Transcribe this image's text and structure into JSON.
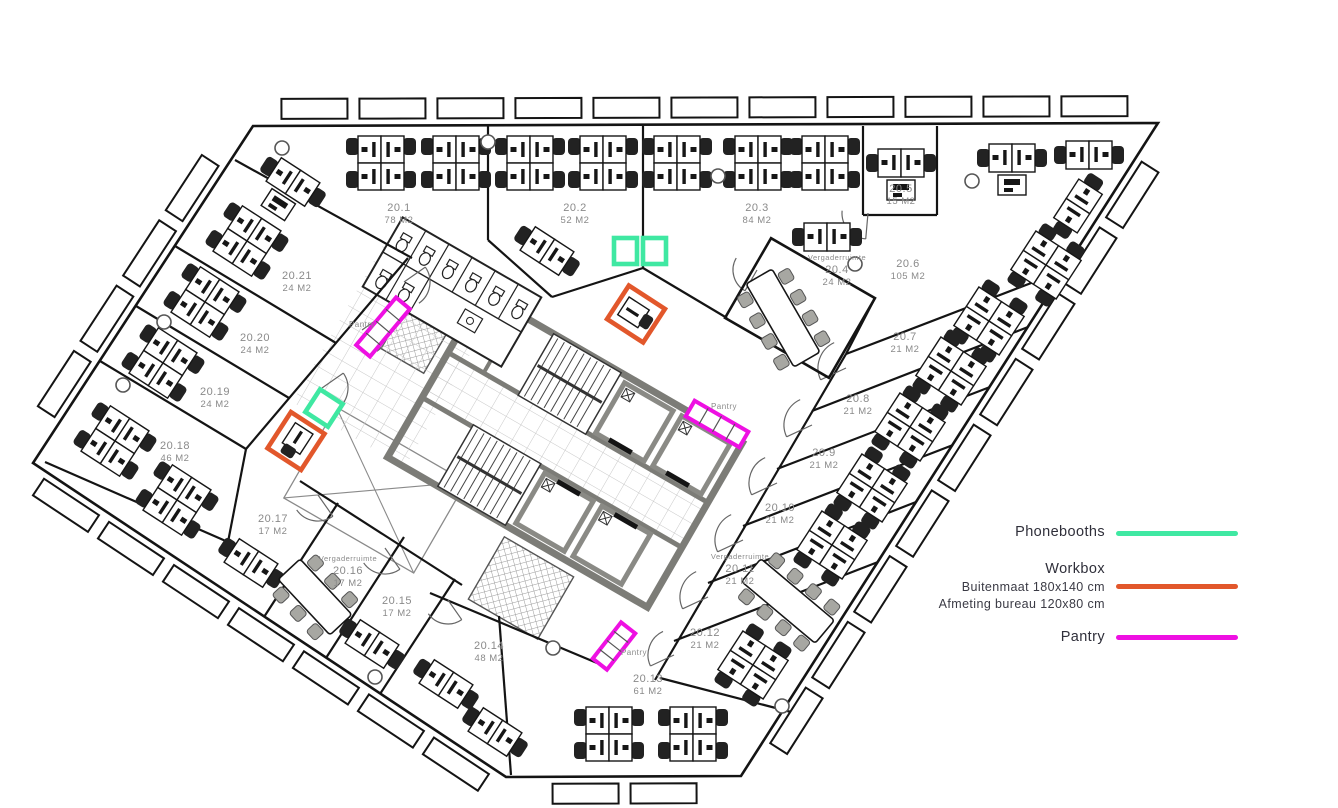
{
  "legend": {
    "phonebooths": {
      "label": "Phonebooths",
      "color": "#3FE8A2"
    },
    "workbox": {
      "label": "Workbox",
      "sub1": "Buitenmaat 180x140 cm",
      "sub2": "Afmeting bureau 120x80 cm",
      "color": "#E2572B"
    },
    "pantry": {
      "label": "Pantry",
      "color": "#EE10E2"
    }
  },
  "plan": {
    "canvas": {
      "w": 1338,
      "h": 808
    },
    "colors": {
      "wall": "#141414",
      "core_gray": "#7C7C77",
      "elev_gray": "#8A8A85",
      "label_gray": "#8A8A8A",
      "chair_black": "#222222",
      "meet_chair": "#A7A7A2",
      "green": "#3FE8A2",
      "orange": "#E2572B",
      "magenta": "#EE10E2"
    },
    "outline": [
      [
        253,
        126
      ],
      [
        1158,
        123
      ],
      [
        741,
        776
      ],
      [
        506,
        777
      ],
      [
        33,
        463
      ]
    ],
    "walls": [
      [
        488,
        126,
        488,
        240
      ],
      [
        488,
        240,
        552,
        297
      ],
      [
        552,
        297,
        643,
        268
      ],
      [
        643,
        126,
        643,
        268
      ],
      [
        643,
        268,
        727,
        318
      ],
      [
        863,
        126,
        863,
        215
      ],
      [
        863,
        215,
        937,
        215
      ],
      [
        937,
        126,
        937,
        215
      ],
      [
        875,
        298,
        846,
        354
      ],
      [
        846,
        354,
        655,
        680
      ],
      [
        846,
        354,
        1060,
        272
      ],
      [
        812,
        411,
        1028,
        327
      ],
      [
        777,
        469,
        990,
        387
      ],
      [
        743,
        526,
        953,
        445
      ],
      [
        708,
        583,
        916,
        502
      ],
      [
        674,
        641,
        878,
        562
      ],
      [
        660,
        678,
        795,
        713
      ],
      [
        235,
        160,
        412,
        258
      ],
      [
        408,
        258,
        246,
        449
      ],
      [
        175,
        246,
        336,
        343
      ],
      [
        136,
        306,
        289,
        398
      ],
      [
        100,
        361,
        246,
        449
      ],
      [
        246,
        449,
        228,
        542
      ],
      [
        45,
        462,
        228,
        542
      ],
      [
        300,
        481,
        462,
        585
      ],
      [
        264,
        617,
        338,
        503
      ],
      [
        326,
        658,
        404,
        537
      ],
      [
        380,
        694,
        455,
        579
      ],
      [
        430,
        593,
        597,
        663
      ],
      [
        499,
        616,
        511,
        775
      ]
    ],
    "core": {
      "x": 565,
      "y": 450,
      "rot": 30
    },
    "toilets": {
      "x": 452,
      "y": 292,
      "rot": 30
    },
    "rooms": [
      {
        "id": "20.1",
        "area": "78 M2",
        "x": 399,
        "y": 207
      },
      {
        "id": "20.2",
        "area": "52 M2",
        "x": 575,
        "y": 207
      },
      {
        "id": "20.3",
        "area": "84 M2",
        "x": 757,
        "y": 207
      },
      {
        "id": "20.4",
        "area": "24 M2",
        "x": 837,
        "y": 269,
        "prefix": "Vergaderruimte"
      },
      {
        "id": "20.5",
        "area": "15 M2",
        "x": 901,
        "y": 188
      },
      {
        "id": "20.6",
        "area": "105 M2",
        "x": 908,
        "y": 263
      },
      {
        "id": "20.7",
        "area": "21 M2",
        "x": 905,
        "y": 336
      },
      {
        "id": "20.8",
        "area": "21 M2",
        "x": 858,
        "y": 398
      },
      {
        "id": "20.9",
        "area": "21 M2",
        "x": 824,
        "y": 452
      },
      {
        "id": "20.10",
        "area": "21 M2",
        "x": 780,
        "y": 507
      },
      {
        "id": "20.11",
        "area": "21 M2",
        "x": 740,
        "y": 568,
        "prefix": "Vergaderruimte"
      },
      {
        "id": "20.12",
        "area": "21 M2",
        "x": 705,
        "y": 632
      },
      {
        "id": "20.13",
        "area": "61 M2",
        "x": 648,
        "y": 678
      },
      {
        "id": "20.14",
        "area": "48 M2",
        "x": 489,
        "y": 645
      },
      {
        "id": "20.15",
        "area": "17 M2",
        "x": 397,
        "y": 600
      },
      {
        "id": "20.16",
        "area": "17 M2",
        "x": 348,
        "y": 570,
        "prefix": "Vergaderruimte"
      },
      {
        "id": "20.17",
        "area": "17 M2",
        "x": 273,
        "y": 518
      },
      {
        "id": "20.18",
        "area": "46 M2",
        "x": 175,
        "y": 445
      },
      {
        "id": "20.19",
        "area": "24 M2",
        "x": 215,
        "y": 391
      },
      {
        "id": "20.20",
        "area": "24 M2",
        "x": 255,
        "y": 337
      },
      {
        "id": "20.21",
        "area": "24 M2",
        "x": 297,
        "y": 275
      }
    ],
    "small_labels": [
      {
        "text": "Pantry",
        "x": 362,
        "y": 327
      },
      {
        "text": "Pantry",
        "x": 724,
        "y": 409
      },
      {
        "text": "Pantry",
        "x": 634,
        "y": 655
      }
    ],
    "arcs": [
      [
        868,
        213,
        26,
        95
      ],
      [
        846,
        368,
        28,
        155
      ],
      [
        812,
        425,
        28,
        155
      ],
      [
        777,
        483,
        28,
        155
      ],
      [
        743,
        540,
        28,
        155
      ],
      [
        708,
        597,
        28,
        155
      ],
      [
        674,
        655,
        26,
        155
      ],
      [
        404,
        282,
        26,
        -35
      ],
      [
        362,
        330,
        26,
        -35
      ],
      [
        322,
        388,
        26,
        -35
      ],
      [
        282,
        445,
        26,
        -35
      ],
      [
        318,
        495,
        26,
        55
      ],
      [
        385,
        548,
        26,
        55
      ],
      [
        448,
        600,
        24,
        55
      ],
      [
        757,
        270,
        24,
        120
      ]
    ],
    "items": [
      {
        "t": "hatch",
        "x": 410,
        "y": 333,
        "r": 30,
        "w": 64,
        "h": 56
      },
      {
        "t": "hatch",
        "x": 521,
        "y": 588,
        "r": 30,
        "w": 80,
        "h": 72
      },
      {
        "t": "xvoid",
        "x": 375,
        "y": 490,
        "r": 30,
        "w": 150,
        "h": 105
      },
      {
        "t": "roomrect",
        "x": 800,
        "y": 308,
        "r": 30,
        "w": 120,
        "h": 92
      },
      {
        "t": "pod4",
        "x": 381,
        "y": 163,
        "r": 0
      },
      {
        "t": "pod4",
        "x": 456,
        "y": 163,
        "r": 0
      },
      {
        "t": "pod4",
        "x": 530,
        "y": 163,
        "r": 0
      },
      {
        "t": "pod4",
        "x": 603,
        "y": 163,
        "r": 0
      },
      {
        "t": "pod4",
        "x": 677,
        "y": 163,
        "r": 0
      },
      {
        "t": "pod4",
        "x": 758,
        "y": 163,
        "r": 0
      },
      {
        "t": "pod4",
        "x": 825,
        "y": 163,
        "r": 0
      },
      {
        "t": "pod2",
        "x": 827,
        "y": 237,
        "r": 0
      },
      {
        "t": "pod2p",
        "x": 901,
        "y": 163,
        "r": 0
      },
      {
        "t": "pod2p",
        "x": 1012,
        "y": 158,
        "r": 0
      },
      {
        "t": "pod2",
        "x": 1089,
        "y": 155,
        "r": 0
      },
      {
        "t": "pod2p",
        "x": 293,
        "y": 182,
        "r": 33
      },
      {
        "t": "pod2",
        "x": 547,
        "y": 251,
        "r": 33
      },
      {
        "t": "pod2",
        "x": 1078,
        "y": 206,
        "r": -57
      },
      {
        "t": "pod4",
        "x": 1046,
        "y": 265,
        "r": -57
      },
      {
        "t": "pod4",
        "x": 989,
        "y": 321,
        "r": -57
      },
      {
        "t": "pod4",
        "x": 951,
        "y": 371,
        "r": -57
      },
      {
        "t": "pod4",
        "x": 910,
        "y": 427,
        "r": -57
      },
      {
        "t": "pod4",
        "x": 872,
        "y": 488,
        "r": -57
      },
      {
        "t": "pod4",
        "x": 832,
        "y": 545,
        "r": -57
      },
      {
        "t": "pod4",
        "x": 753,
        "y": 665,
        "r": -57
      },
      {
        "t": "pod4",
        "x": 609,
        "y": 734,
        "r": 0
      },
      {
        "t": "pod4",
        "x": 693,
        "y": 734,
        "r": 0
      },
      {
        "t": "pod2",
        "x": 446,
        "y": 684,
        "r": 33
      },
      {
        "t": "pod2",
        "x": 495,
        "y": 732,
        "r": 33
      },
      {
        "t": "pod2",
        "x": 372,
        "y": 644,
        "r": 33
      },
      {
        "t": "pod2",
        "x": 251,
        "y": 563,
        "r": 33
      },
      {
        "t": "pod4",
        "x": 247,
        "y": 241,
        "r": 33
      },
      {
        "t": "pod4",
        "x": 205,
        "y": 302,
        "r": 33
      },
      {
        "t": "pod4",
        "x": 163,
        "y": 363,
        "r": 33
      },
      {
        "t": "pod4",
        "x": 115,
        "y": 441,
        "r": 33
      },
      {
        "t": "pod4",
        "x": 177,
        "y": 500,
        "r": 33
      },
      {
        "t": "meet",
        "x": 783,
        "y": 318,
        "r": -30,
        "seats": 8
      },
      {
        "t": "meet",
        "x": 788,
        "y": 601,
        "r": -50,
        "seats": 8
      },
      {
        "t": "meet",
        "x": 315,
        "y": 597,
        "r": -43,
        "seats": 6
      },
      {
        "t": "booth2",
        "x": 640,
        "y": 251,
        "r": 0
      },
      {
        "t": "booth1",
        "x": 324,
        "y": 408,
        "r": 33
      },
      {
        "t": "wbox",
        "x": 296,
        "y": 441,
        "r": 33
      },
      {
        "t": "wbox",
        "x": 636,
        "y": 314,
        "r": -57
      },
      {
        "t": "pbox",
        "x": 383,
        "y": 327,
        "r": -50,
        "len": 62
      },
      {
        "t": "pbox",
        "x": 717,
        "y": 424,
        "r": 30,
        "len": 62
      },
      {
        "t": "pbox",
        "x": 614,
        "y": 646,
        "r": -52,
        "len": 46
      },
      {
        "t": "col",
        "x": 282,
        "y": 148
      },
      {
        "t": "col",
        "x": 488,
        "y": 142
      },
      {
        "t": "col",
        "x": 718,
        "y": 176
      },
      {
        "t": "col",
        "x": 972,
        "y": 181
      },
      {
        "t": "col",
        "x": 855,
        "y": 264
      },
      {
        "t": "col",
        "x": 164,
        "y": 322
      },
      {
        "t": "col",
        "x": 123,
        "y": 385
      },
      {
        "t": "col",
        "x": 375,
        "y": 677
      },
      {
        "t": "col",
        "x": 553,
        "y": 648
      },
      {
        "t": "col",
        "x": 782,
        "y": 706
      }
    ]
  }
}
